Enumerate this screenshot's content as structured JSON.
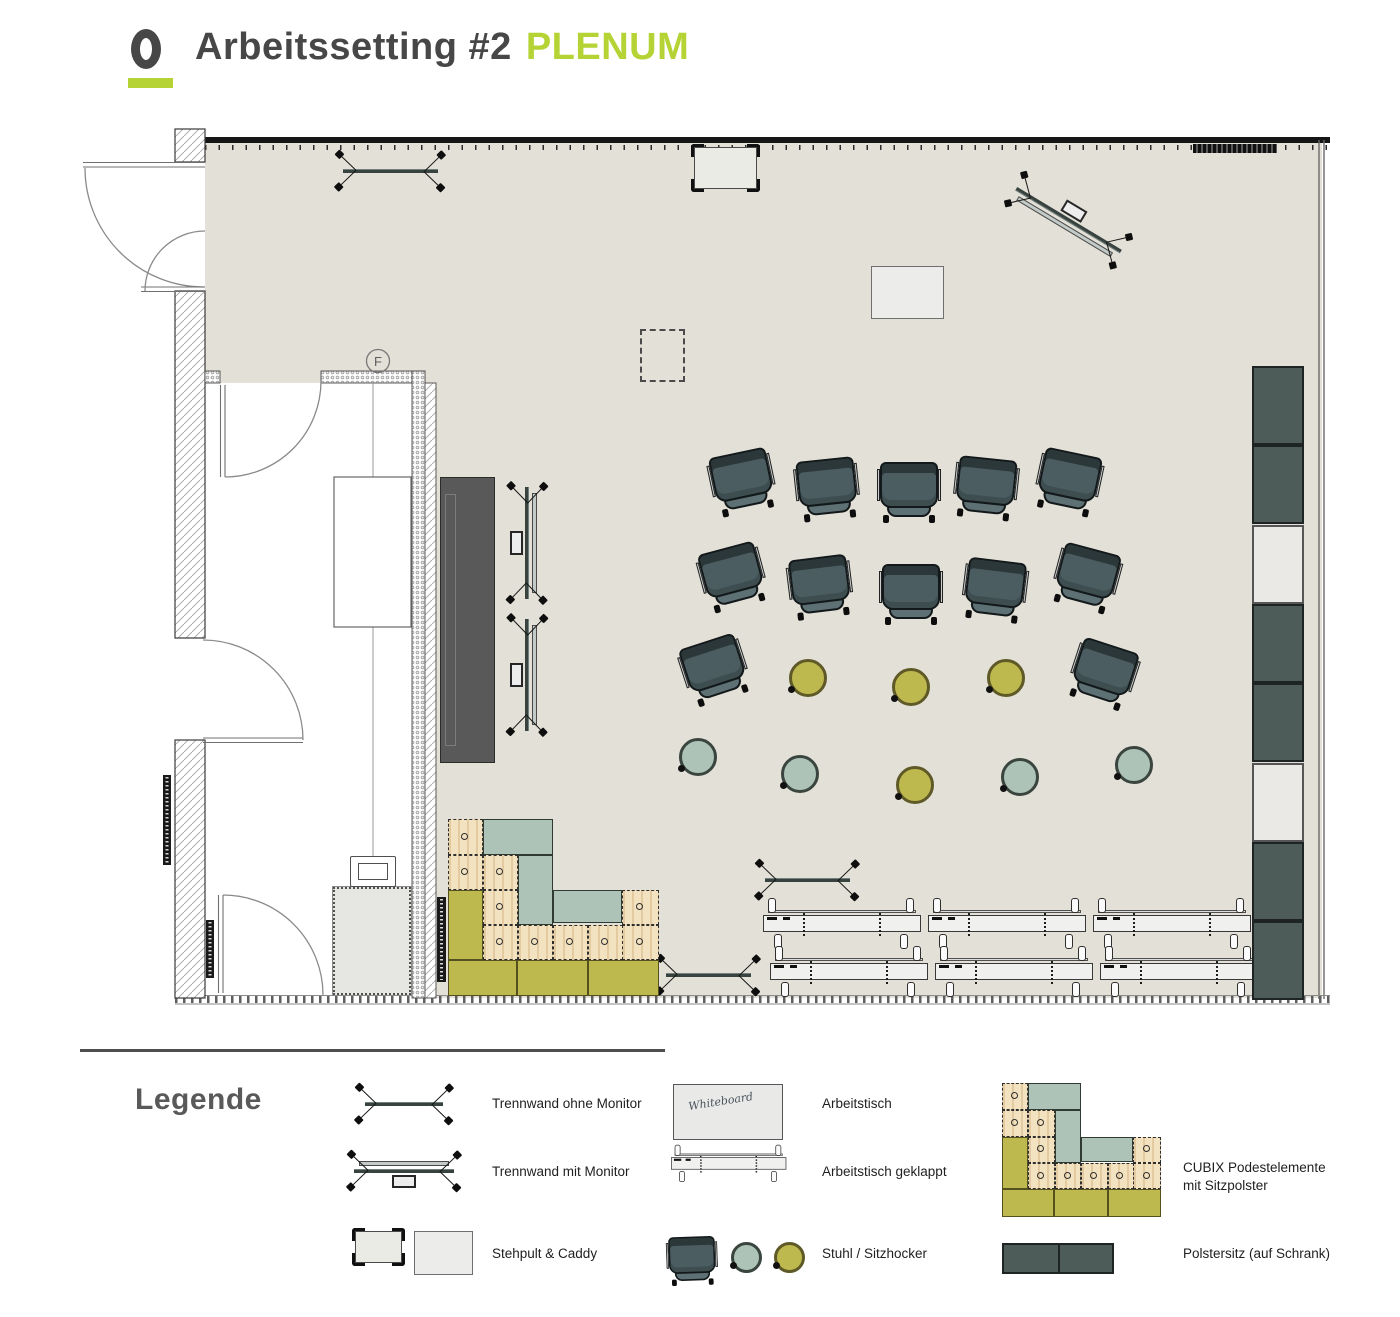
{
  "title": {
    "text": "Arbeitssetting #2",
    "highlight": "PLENUM"
  },
  "colors": {
    "accent": "#b5d334",
    "ink": "#474747",
    "floor": "#e3e0d7",
    "chair": "#4b5d61",
    "teal": "#aec3b7",
    "olive": "#bdb94f",
    "wood": "#f3e2c0",
    "slate": "#4d5b59"
  },
  "plan": {
    "room_label": "F",
    "chairs": [
      {
        "x": 742,
        "y": 480,
        "rot": -12
      },
      {
        "x": 827,
        "y": 487,
        "rot": -6
      },
      {
        "x": 909,
        "y": 490,
        "rot": 0
      },
      {
        "x": 986,
        "y": 486,
        "rot": 6
      },
      {
        "x": 1069,
        "y": 480,
        "rot": 12
      },
      {
        "x": 732,
        "y": 575,
        "rot": -15
      },
      {
        "x": 820,
        "y": 585,
        "rot": -7
      },
      {
        "x": 911,
        "y": 592,
        "rot": 0
      },
      {
        "x": 995,
        "y": 588,
        "rot": 7
      },
      {
        "x": 1087,
        "y": 576,
        "rot": 15
      },
      {
        "x": 714,
        "y": 668,
        "rot": -18
      },
      {
        "x": 1104,
        "y": 672,
        "rot": 18
      }
    ],
    "stools": [
      {
        "x": 808,
        "y": 678,
        "c": "olive"
      },
      {
        "x": 911,
        "y": 687,
        "c": "olive"
      },
      {
        "x": 1006,
        "y": 678,
        "c": "olive"
      },
      {
        "x": 698,
        "y": 757,
        "c": "teal"
      },
      {
        "x": 800,
        "y": 774,
        "c": "teal"
      },
      {
        "x": 915,
        "y": 785,
        "c": "olive"
      },
      {
        "x": 1020,
        "y": 777,
        "c": "teal"
      },
      {
        "x": 1134,
        "y": 765,
        "c": "teal"
      }
    ],
    "partitions": [
      {
        "cx": 390,
        "cy": 170,
        "len": 95,
        "rot": 0,
        "monitor": false
      },
      {
        "cx": 807,
        "cy": 879,
        "len": 85,
        "rot": 0,
        "monitor": false
      },
      {
        "cx": 708,
        "cy": 974,
        "len": 85,
        "rot": 0,
        "monitor": false
      },
      {
        "cx": 528,
        "cy": 543,
        "len": 112,
        "rot": 90,
        "monitor": true
      },
      {
        "cx": 528,
        "cy": 675,
        "len": 112,
        "rot": 90,
        "monitor": true
      },
      {
        "cx": 1068,
        "cy": 221,
        "len": 122,
        "rot": 31,
        "monitor": true,
        "flip": true
      }
    ],
    "folded_tables": [
      {
        "x": 763,
        "y": 901
      },
      {
        "x": 928,
        "y": 901
      },
      {
        "x": 1093,
        "y": 901
      },
      {
        "x": 770,
        "y": 949
      },
      {
        "x": 935,
        "y": 949
      },
      {
        "x": 1100,
        "y": 949
      }
    ],
    "cabinets": [
      {
        "y": 366,
        "t": "d"
      },
      {
        "y": 445,
        "t": "d"
      },
      {
        "y": 525,
        "t": "l"
      },
      {
        "y": 604,
        "t": "d"
      },
      {
        "y": 683,
        "t": "d"
      },
      {
        "y": 763,
        "t": "l"
      },
      {
        "y": 842,
        "t": "d"
      },
      {
        "y": 921,
        "t": "d"
      }
    ],
    "cubix": {
      "origin": {
        "x": 448,
        "y": 819
      },
      "tiles": [
        {
          "x": 448,
          "y": 819,
          "w": 35,
          "h": 36,
          "t": "wood"
        },
        {
          "x": 483,
          "y": 819,
          "w": 70,
          "h": 36,
          "t": "teal"
        },
        {
          "x": 448,
          "y": 855,
          "w": 35,
          "h": 35,
          "t": "wood"
        },
        {
          "x": 483,
          "y": 855,
          "w": 35,
          "h": 35,
          "t": "wood"
        },
        {
          "x": 518,
          "y": 855,
          "w": 35,
          "h": 70,
          "t": "teal"
        },
        {
          "x": 448,
          "y": 890,
          "w": 35,
          "h": 70,
          "t": "olive"
        },
        {
          "x": 483,
          "y": 890,
          "w": 35,
          "h": 35,
          "t": "wood"
        },
        {
          "x": 553,
          "y": 890,
          "w": 69,
          "h": 33,
          "t": "teal"
        },
        {
          "x": 622,
          "y": 890,
          "w": 37,
          "h": 35,
          "t": "wood"
        },
        {
          "x": 483,
          "y": 925,
          "w": 35,
          "h": 35,
          "t": "wood"
        },
        {
          "x": 518,
          "y": 925,
          "w": 35,
          "h": 35,
          "t": "wood"
        },
        {
          "x": 553,
          "y": 925,
          "w": 35,
          "h": 35,
          "t": "wood"
        },
        {
          "x": 588,
          "y": 925,
          "w": 35,
          "h": 35,
          "t": "wood"
        },
        {
          "x": 622,
          "y": 925,
          "w": 37,
          "h": 35,
          "t": "wood"
        },
        {
          "x": 448,
          "y": 960,
          "w": 69,
          "h": 36,
          "t": "olive"
        },
        {
          "x": 517,
          "y": 960,
          "w": 71,
          "h": 36,
          "t": "olive"
        },
        {
          "x": 588,
          "y": 960,
          "w": 71,
          "h": 36,
          "t": "olive"
        }
      ]
    }
  },
  "legend": {
    "heading": "Legende",
    "col1": [
      {
        "label": "Trennwand ohne Monitor"
      },
      {
        "label": "Trennwand mit Monitor"
      },
      {
        "label": "Stehpult & Caddy"
      }
    ],
    "col2": [
      {
        "label": "Arbeitstisch"
      },
      {
        "label": "Arbeitstisch geklappt"
      },
      {
        "label": "Stuhl / Sitzhocker"
      }
    ],
    "col3": [
      {
        "label": "CUBIX Podestelemente mit Sitzpolster"
      },
      {
        "label": "Polstersitz (auf Schrank)"
      }
    ],
    "whiteboard_note": "Whiteboard"
  }
}
